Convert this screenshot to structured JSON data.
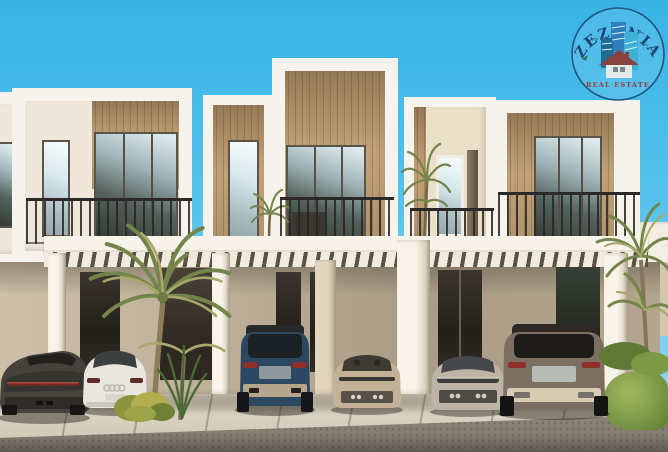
{
  "meta": {
    "width_px": 668,
    "height_px": 452,
    "description": "Architectural rendering of a row of modern two-storey townhouses with white parapet frames, wood-slat cladding, balconies with dark metal railings and a slatted carport pergola; six cars parked in the driveways, palm trees and shrubs, clear blue sky; ZEZENIA Real Estate watermark top right"
  },
  "watermark": {
    "brand": "ZEZENIA",
    "tagline": "REAL ESTATE"
  },
  "palette": {
    "sky_top": "#38b2e5",
    "sky_mid": "#55c3ec",
    "sky_bottom": "#9cdcf3",
    "frame_white": "#f6f3ec",
    "wall_cream": "#efe7d9",
    "wood_light": "#c9a87e",
    "wood_dark": "#a98c66",
    "canopy_white": "#f7f3ea",
    "slat_gap": "#5a5243",
    "pavement": "#d9d2c2",
    "road": "#847e71",
    "grass": "#7d9a47",
    "palm_green": "#74854c",
    "palm_light": "#a8a86b",
    "logo_navy": "#1a3c6b",
    "logo_blue": "#2f7ab8",
    "logo_teal": "#3fb0d4",
    "logo_red": "#9c342c",
    "car_dark_grey": "#45423c",
    "car_white": "#e9e6df",
    "car_blue": "#2c4760",
    "car_beige": "#c3b298",
    "car_silver": "#bdb4a5",
    "car_bronze": "#7b6f61"
  },
  "scene": {
    "vehicles": [
      {
        "name": "dark-grey sports car",
        "position": "far-left driveway"
      },
      {
        "name": "white sedan with four-ring badge",
        "position": "left driveway behind palm"
      },
      {
        "name": "dark-blue SUV",
        "position": "centre-left carport bay"
      },
      {
        "name": "beige convertible",
        "position": "centre carport bay"
      },
      {
        "name": "silver sports coupe",
        "position": "centre-right carport bay"
      },
      {
        "name": "bronze SUV",
        "position": "right carport bay"
      }
    ],
    "landscaping": [
      "tall palm in front of left units",
      "slender palm on centre-right balcony",
      "palm cluster and shrubs at right edge",
      "yellow-green shrubs beside driveway"
    ]
  }
}
